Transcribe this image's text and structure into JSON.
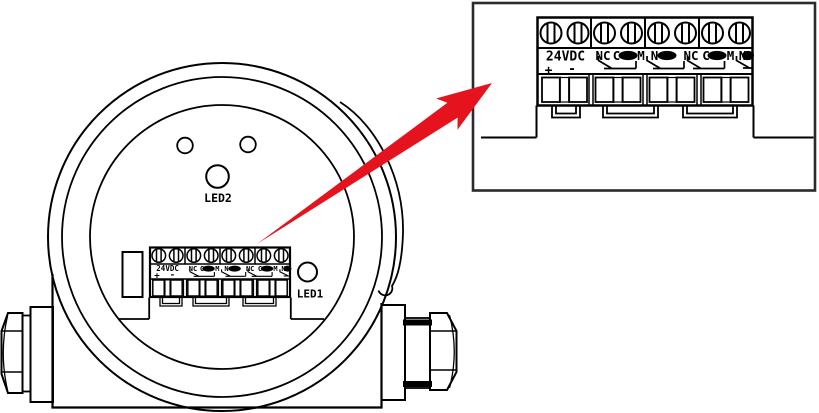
{
  "views": {
    "front": {
      "led1": "LED1",
      "led2": "LED2"
    },
    "detail": {
      "description": ""
    }
  },
  "terminal": {
    "power_label": "24VDC",
    "plus": "+",
    "minus": "-",
    "contacts": [
      "NC",
      "COM",
      "NO",
      "NC",
      "COM",
      "NO"
    ],
    "glyphs": {
      "nc": "NC",
      "c": "C",
      "m": "M",
      "n": "N"
    }
  },
  "colors": {
    "arrow": "#e4131e",
    "ink": "#000000",
    "detail_border": "#2b2b2b"
  }
}
